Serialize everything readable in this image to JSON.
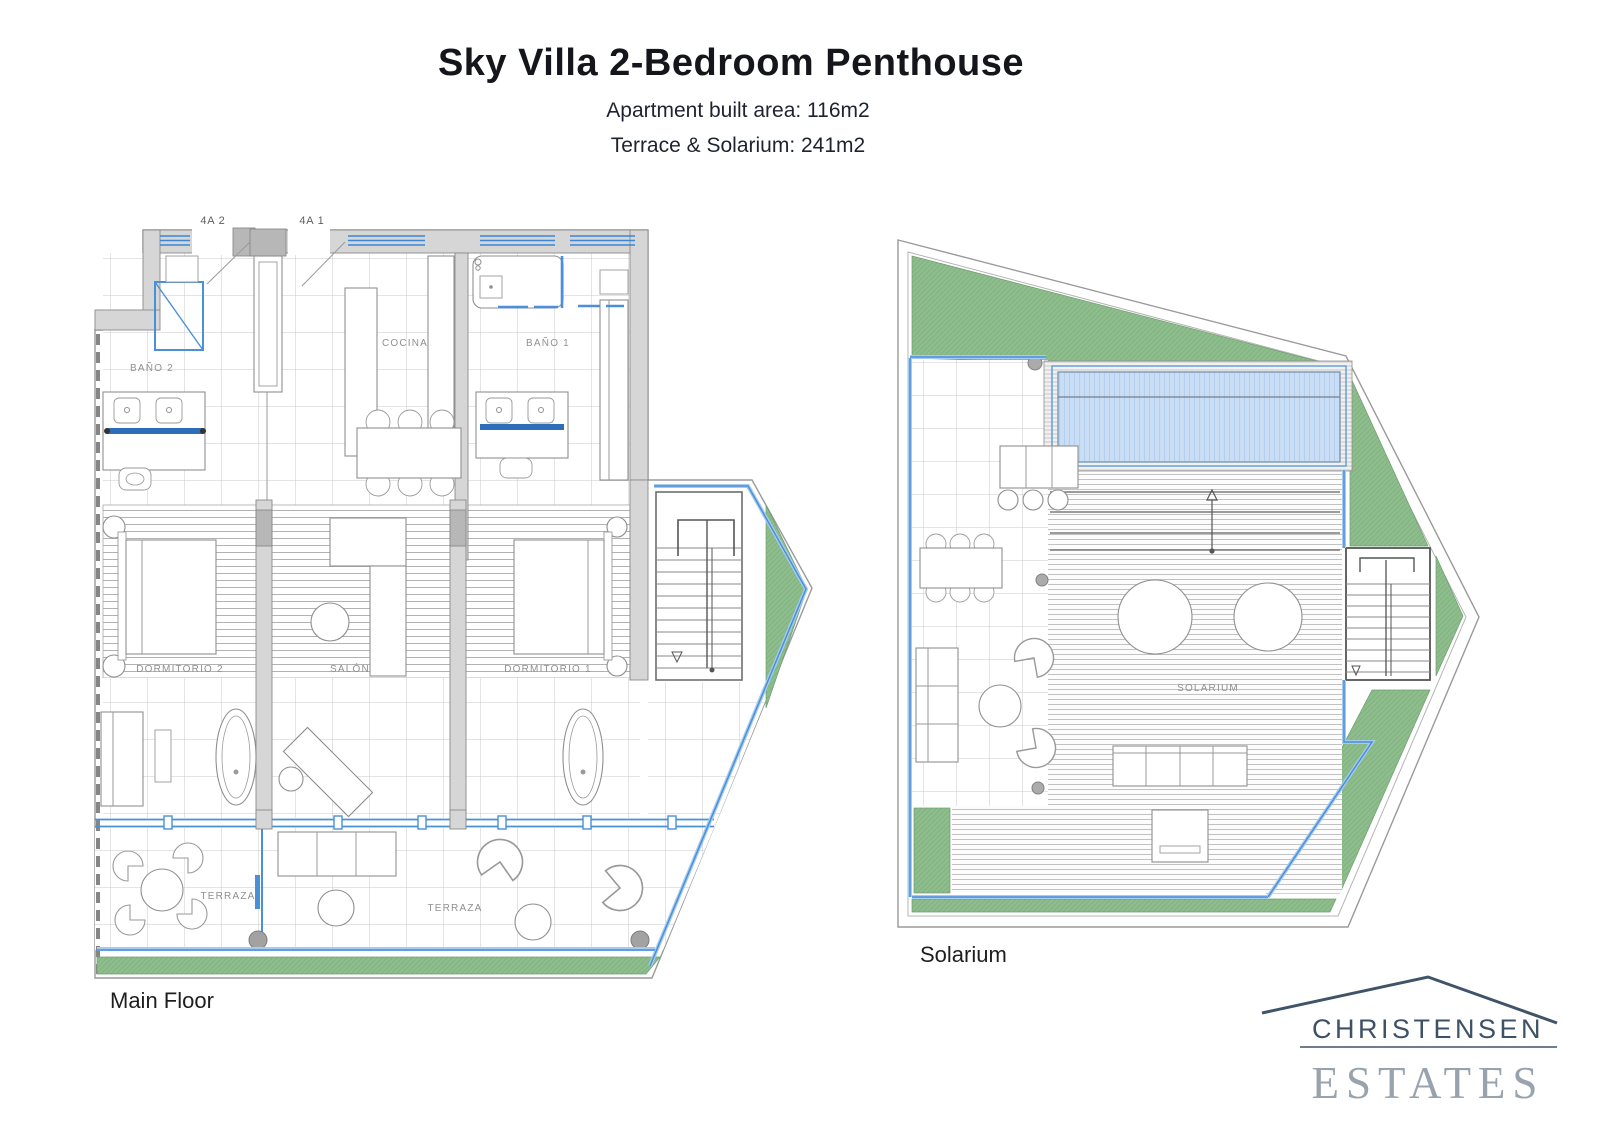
{
  "header": {
    "title": "Sky Villa 2-Bedroom Penthouse",
    "subtitle1": "Apartment built area: 116m2",
    "subtitle2": "Terrace & Solarium: 241m2"
  },
  "main_floor": {
    "caption": "Main Floor",
    "door_label_1": "4A 2",
    "door_label_2": "4A 1",
    "rooms": {
      "bano2": "BAÑO 2",
      "cocina": "COCINA",
      "bano1": "BAÑO 1",
      "dormitorio2": "DORMITORIO 2",
      "salon": "SALÓN",
      "dormitorio1": "DORMITORIO 1",
      "terraza1": "TERRAZA",
      "terraza2": "TERRAZA"
    }
  },
  "solarium": {
    "caption": "Solarium",
    "rooms": {
      "solarium": "SOLARIUM"
    }
  },
  "logo": {
    "name": "CHRISTENSEN",
    "type": "ESTATES"
  },
  "colors": {
    "glass_blue": "#4a90d9",
    "pool_blue": "#c9def5",
    "grass_green": "#8dbd8c",
    "wall_gray": "#d6d6d6",
    "logo_navy": "#3d5266",
    "logo_gray": "#98a3ae",
    "vanity_blue": "#2e6db8"
  }
}
